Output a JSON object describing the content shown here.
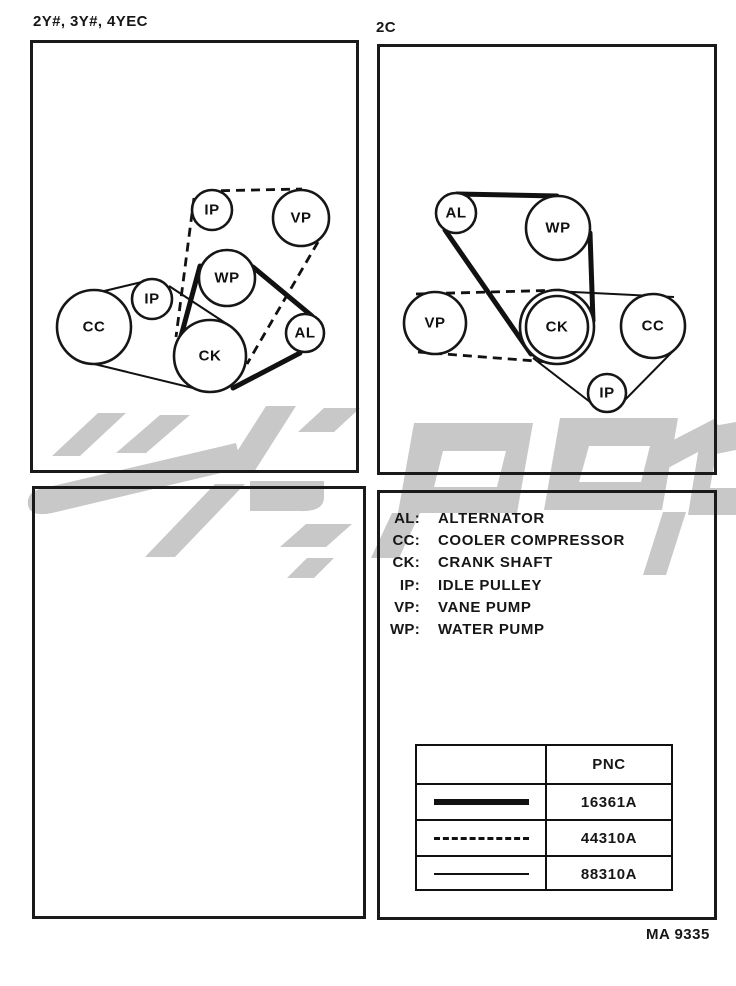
{
  "page": {
    "left_section_label": "2Y#, 3Y#, 4YEC",
    "right_section_label": "2C",
    "figure_code": "MA 9335"
  },
  "diagram_left": {
    "pulleys": [
      {
        "label": "IP"
      },
      {
        "label": "VP"
      },
      {
        "label": "WP"
      },
      {
        "label": "IP"
      },
      {
        "label": "CC"
      },
      {
        "label": "CK"
      },
      {
        "label": "AL"
      }
    ]
  },
  "diagram_right": {
    "pulleys": [
      {
        "label": "AL"
      },
      {
        "label": "WP"
      },
      {
        "label": "VP"
      },
      {
        "label": "CK"
      },
      {
        "label": "CC"
      },
      {
        "label": "IP"
      }
    ]
  },
  "legend": {
    "entries": [
      {
        "abbr": "AL:",
        "name": "ALTERNATOR"
      },
      {
        "abbr": "CC:",
        "name": "COOLER COMPRESSOR"
      },
      {
        "abbr": "CK:",
        "name": "CRANK SHAFT"
      },
      {
        "abbr": "IP:",
        "name": "IDLE PULLEY"
      },
      {
        "abbr": "VP:",
        "name": "VANE PUMP"
      },
      {
        "abbr": "WP:",
        "name": "WATER PUMP"
      }
    ]
  },
  "belt_table": {
    "header_pnc": "PNC",
    "rows": [
      {
        "line_style": "thick-solid",
        "pnc": "16361A"
      },
      {
        "line_style": "dashed",
        "pnc": "44310A"
      },
      {
        "line_style": "thin-solid",
        "pnc": "88310A"
      }
    ]
  },
  "colors": {
    "ink": "#161616",
    "watermark": "#c8c8c8",
    "paper": "#ffffff"
  }
}
